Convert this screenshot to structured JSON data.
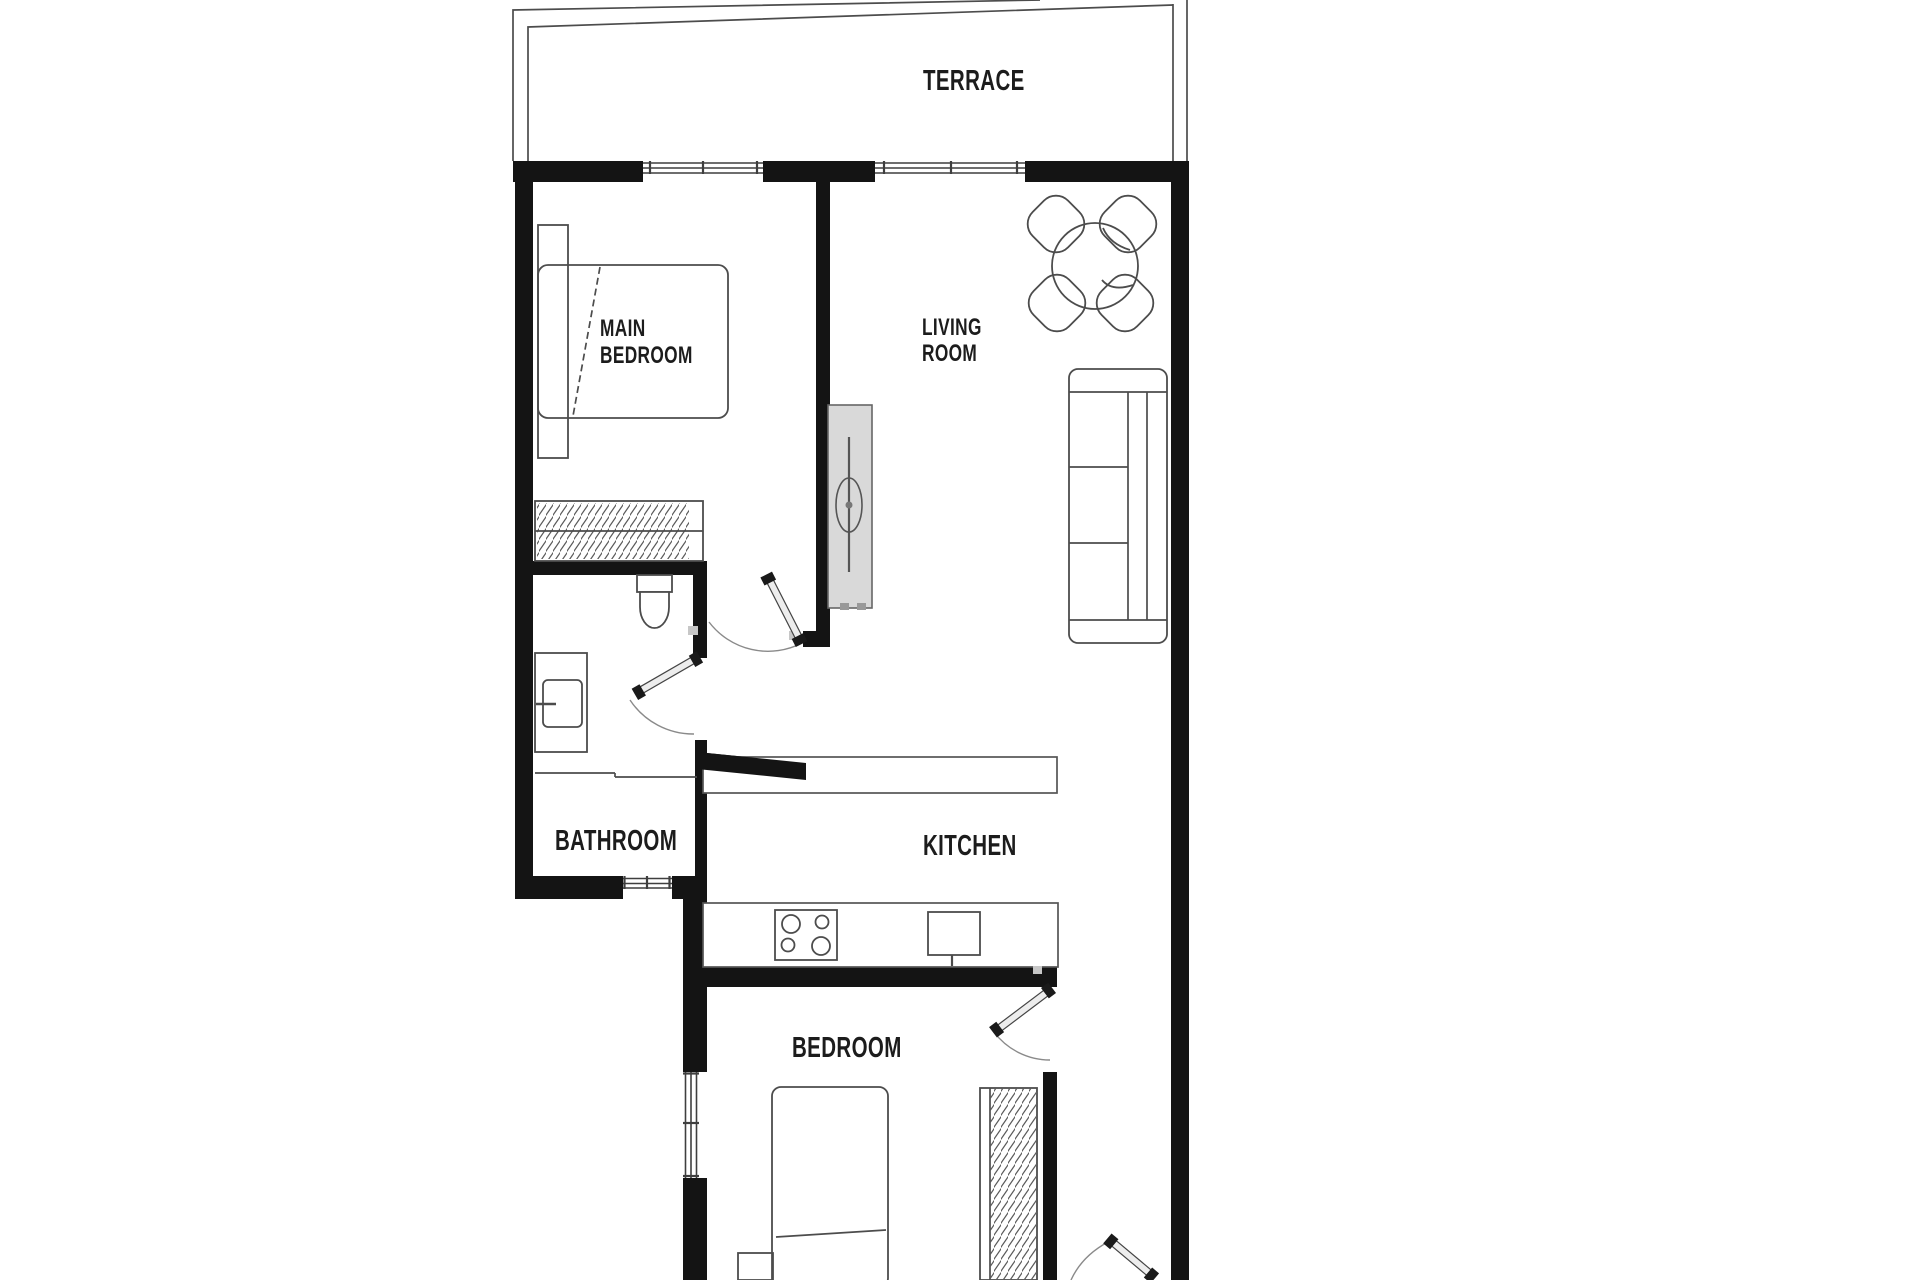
{
  "image_type": "apartment floor plan",
  "rooms": [
    {
      "id": "terrace",
      "label": "TERRACE"
    },
    {
      "id": "main-bedroom",
      "lines": [
        "MAIN",
        "BEDROOM"
      ]
    },
    {
      "id": "living-room",
      "lines": [
        "LIVING",
        "ROOM"
      ]
    },
    {
      "id": "bathroom",
      "label": "BATHROOM"
    },
    {
      "id": "kitchen",
      "label": "KITCHEN"
    },
    {
      "id": "bedroom",
      "label": "BEDROOM"
    }
  ],
  "colors": {
    "background": "#ffffff",
    "wall": "#141414",
    "outline": "#4c4c4c",
    "tv_unit_fill": "#d9d9d9",
    "label": "#1c1c1c"
  }
}
